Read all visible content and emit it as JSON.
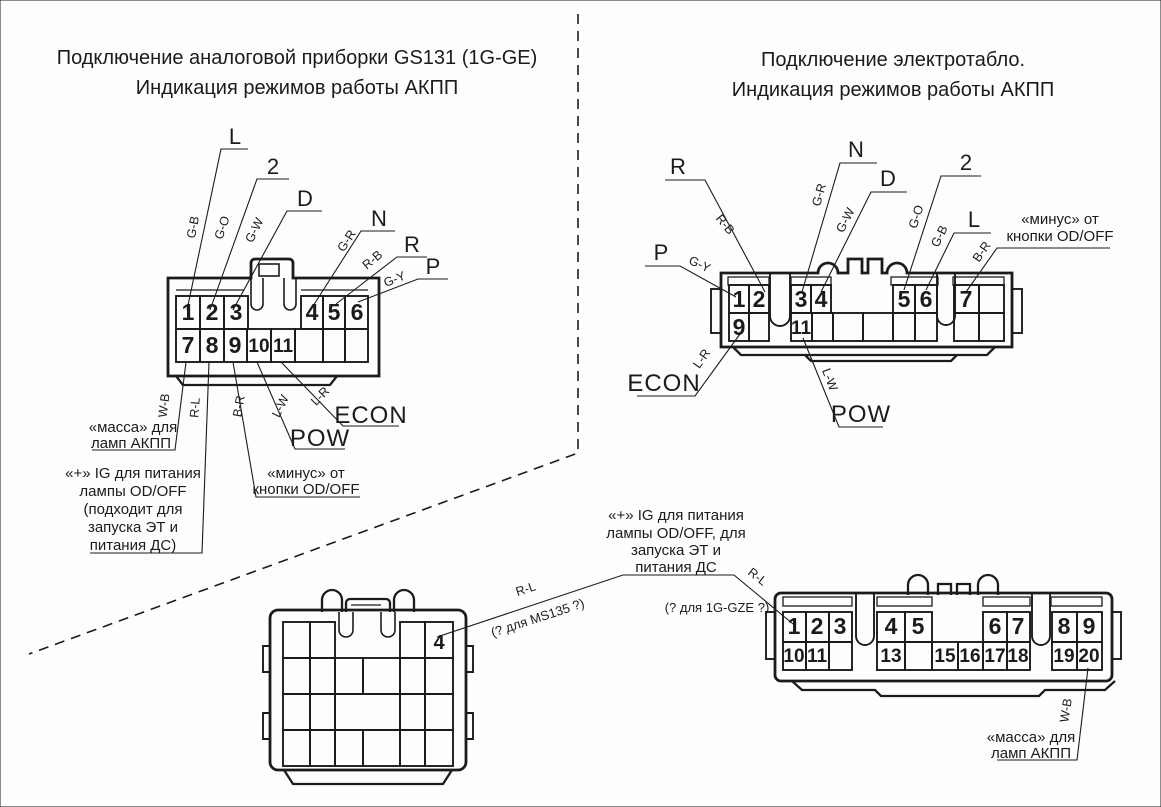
{
  "colors": {
    "ink": "#1b1b1b",
    "grid": "#c9c9c9",
    "paper": "#fdfdfd"
  },
  "titles": {
    "left1": "Подключение аналоговой приборки GS131 (1G-GE)",
    "left2": "Индикация режимов работы АКПП",
    "right1": "Подключение электротабло.",
    "right2": "Индикация режимов работы АКПП"
  },
  "left_connector": {
    "pins_top": [
      "1",
      "2",
      "3",
      "4",
      "5",
      "6"
    ],
    "pins_bottom": [
      "7",
      "8",
      "9",
      "10",
      "11"
    ],
    "gears": [
      {
        "label": "L",
        "wire": "G-B"
      },
      {
        "label": "2",
        "wire": "G-O"
      },
      {
        "label": "D",
        "wire": "G-W"
      },
      {
        "label": "N",
        "wire": "G-R"
      },
      {
        "label": "R",
        "wire": "R-B"
      },
      {
        "label": "P",
        "wire": "G-Y"
      }
    ],
    "bottom_wires": [
      "W-B",
      "R-L",
      "B-R",
      "L-W",
      "L-R"
    ],
    "ann_massa": [
      "«масса» для",
      "ламп АКПП"
    ],
    "ann_plus_ig": [
      "«+» IG для питания",
      "лампы OD/OFF",
      "(подходит для",
      "запуска ЭТ и",
      "питания ДС)"
    ],
    "ann_minus": [
      "«минус» от",
      "кнопки OD/OFF"
    ],
    "pow": "POW",
    "econ": "ECON"
  },
  "right_connector": {
    "pins_top": [
      "1",
      "2",
      "3",
      "4",
      "5",
      "6",
      "7"
    ],
    "pins_bottom": [
      "9",
      "11"
    ],
    "gears": [
      {
        "label": "P",
        "wire": "G-Y"
      },
      {
        "label": "R",
        "wire": "R-B"
      },
      {
        "label": "N",
        "wire": "G-R"
      },
      {
        "label": "D",
        "wire": "G-W"
      },
      {
        "label": "2",
        "wire": "G-O"
      },
      {
        "label": "L",
        "wire": "G-B"
      }
    ],
    "ann_minus": [
      "«минус» от",
      "кнопки OD/OFF"
    ],
    "minus_wire": "B-R",
    "econ": "ECON",
    "econ_wire": "L-R",
    "pow": "POW",
    "pow_wire": "L-W"
  },
  "middle_annotation": {
    "lines": [
      "«+» IG для питания",
      "лампы OD/OFF, для",
      "запуска ЭТ и",
      "питания ДС"
    ],
    "left_wire": "R-L",
    "left_note": "(? для MS135 ?)",
    "right_wire": "R-L",
    "right_note": "(? для 1G-GZE ?)"
  },
  "bottom_left_connector": {
    "pin": "4"
  },
  "bottom_right_connector": {
    "pins_top": [
      "1",
      "2",
      "3",
      "4",
      "5",
      "6",
      "7",
      "8",
      "9"
    ],
    "pins_bottom": [
      "10",
      "11",
      "13",
      "15",
      "16",
      "17",
      "18",
      "19",
      "20"
    ],
    "ann_massa": [
      "«масса» для",
      "ламп АКПП"
    ],
    "massa_wire": "W-B"
  }
}
